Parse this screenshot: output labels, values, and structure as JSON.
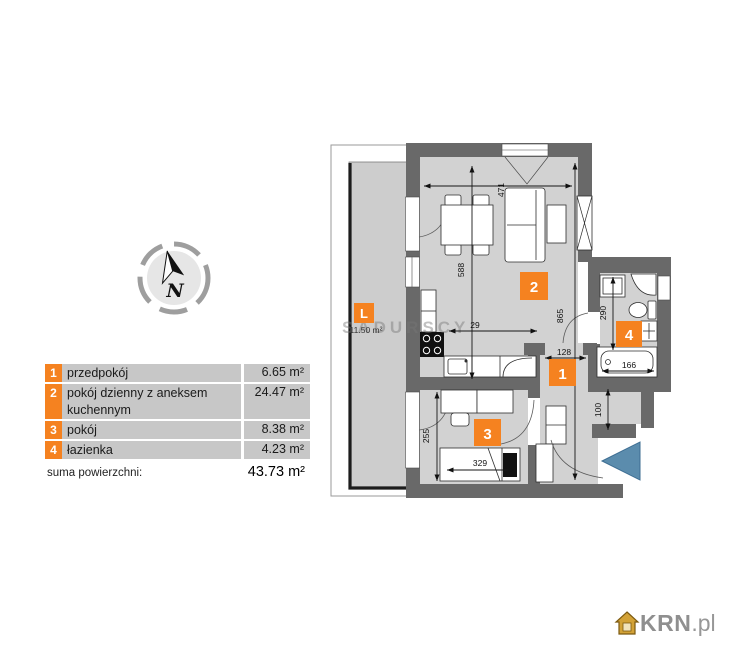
{
  "legend": {
    "rows": [
      {
        "num": "1",
        "name": "przedpokój",
        "area": "6.65 m²"
      },
      {
        "num": "2",
        "name": "pokój dzienny z aneksem kuchennym",
        "area": "24.47 m²"
      },
      {
        "num": "3",
        "name": "pokój",
        "area": "8.38 m²"
      },
      {
        "num": "4",
        "name": "łazienka",
        "area": "4.23 m²"
      }
    ],
    "total_label": "suma powierzchni:",
    "total_value": "43.73 m²"
  },
  "compass": {
    "letter": "N"
  },
  "plan": {
    "badges": {
      "room1": "1",
      "room2": "2",
      "room3": "3",
      "room4": "4",
      "balcony": "L"
    },
    "balcony_area": "11.50 m²",
    "dims": {
      "d471": "471",
      "d588": "588",
      "d865": "865",
      "d29": "29",
      "d128": "128",
      "d290": "290",
      "d166": "166",
      "d255": "255",
      "d329": "329",
      "d100": "100"
    }
  },
  "watermark": "SADURSCY",
  "logo": {
    "name": "KRN",
    "tld": ".pl"
  },
  "colors": {
    "accent_orange": "#f58220",
    "entrance_arrow_blue": "#5b8cad",
    "wall_gray": "#696969",
    "room_fill": "#d2d2d2",
    "legend_row_bg": "#c7c7c7"
  }
}
